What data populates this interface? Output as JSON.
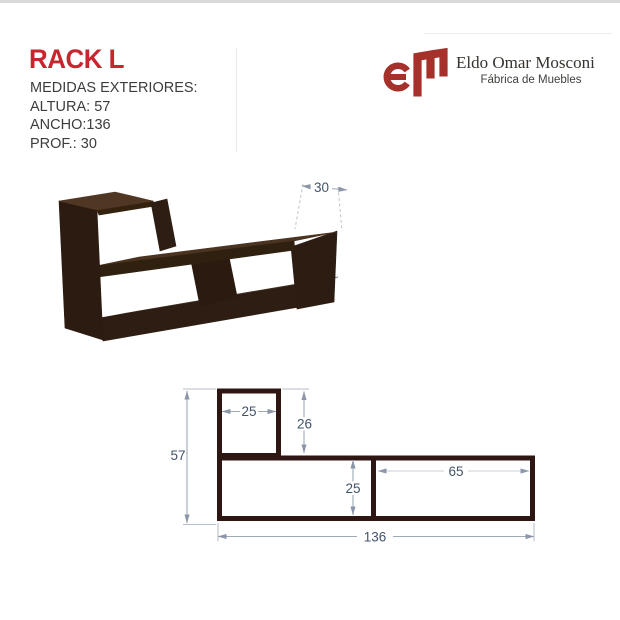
{
  "header": {
    "title": "RACK L",
    "specs": [
      "MEDIDAS EXTERIORES:",
      "ALTURA: 57",
      "ANCHO:136",
      "PROF.: 30"
    ]
  },
  "brand": {
    "monogram": "EM",
    "name": "Eldo Omar Mosconi",
    "tagline": "Fábrica de Muebles"
  },
  "photo": {
    "depth_dim": "30"
  },
  "diagram": {
    "total_height": "57",
    "top_box_width": "25",
    "top_box_height": "26",
    "lower_height": "25",
    "right_compartment_width": "65",
    "total_width": "136"
  },
  "colors": {
    "accent_red": "#c9252e",
    "logo_red": "#a5312a",
    "wood_dark": "#2c1b11",
    "outline_brown": "#2e1712",
    "dim_text_blue": "#43536a"
  }
}
